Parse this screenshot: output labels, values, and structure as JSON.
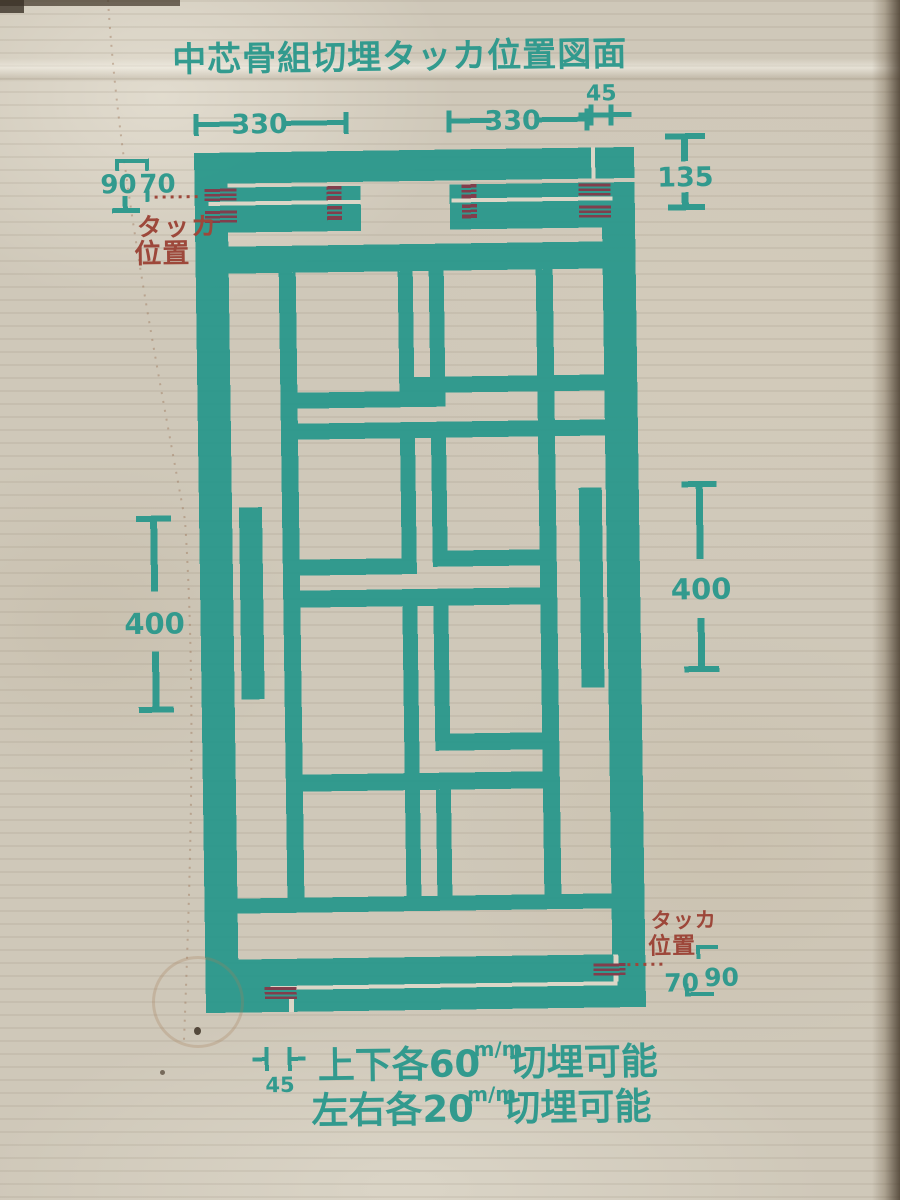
{
  "title": "中芯骨組切埋タッカ位置図面",
  "colors": {
    "ink_teal": "#2a988c",
    "ink_red": "#9b4134",
    "staple_red": "#7d3747",
    "paper_line": "#ddd7c8",
    "cardboard": "#cfc8b9"
  },
  "dimensions": {
    "top_left": "330",
    "top_right": "330",
    "top_offset": "45",
    "left_outer": "90",
    "left_inner": "70",
    "right_head": "135",
    "left_side": "400",
    "right_side": "400",
    "bottom_inner": "70",
    "bottom_outer": "90",
    "bottom_offset": "45"
  },
  "labels": {
    "stapler_top": {
      "line1": "タッカ",
      "line2": "位置"
    },
    "stapler_bottom": {
      "line1": "タッカ",
      "line2": "位置"
    }
  },
  "notes": {
    "line1_prefix": "上下各60",
    "line1_unit": "m/m",
    "line1_suffix": "切埋可能",
    "line2_prefix": "左右各20",
    "line2_unit": "m/m",
    "line2_suffix": "切埋可能"
  }
}
